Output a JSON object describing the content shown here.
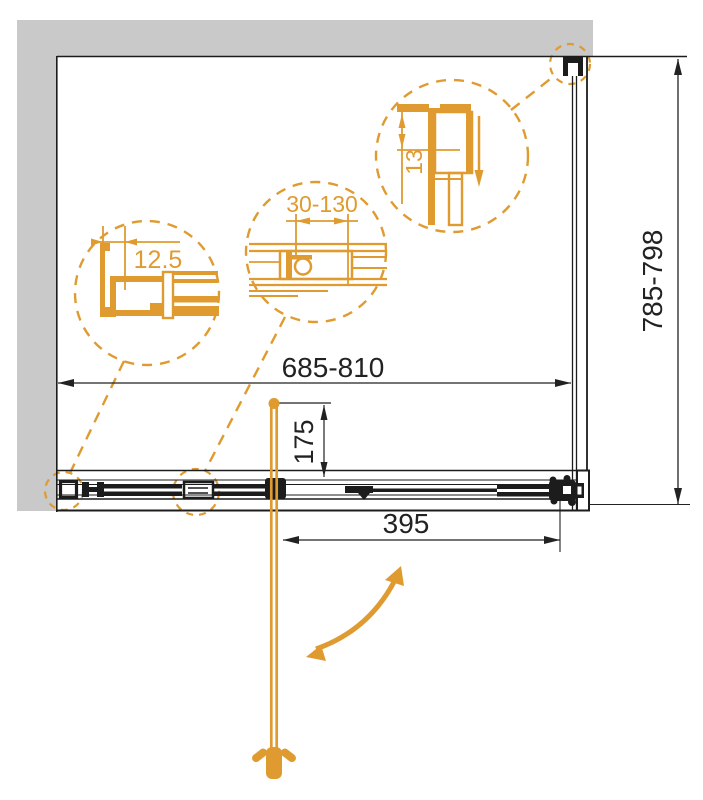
{
  "dimensions": {
    "overall_width": "685-810",
    "overall_height": "785-798",
    "door_panel_width": "395",
    "handle_offset": "175"
  },
  "details": {
    "wall_profile_width": "12.5",
    "adjustment_range": "30-130",
    "profile_depth": "13"
  },
  "colors": {
    "accent_orange": "#DF9B30",
    "wall_gray": "#C9C9C9",
    "line_black": "#1C1C1C"
  }
}
